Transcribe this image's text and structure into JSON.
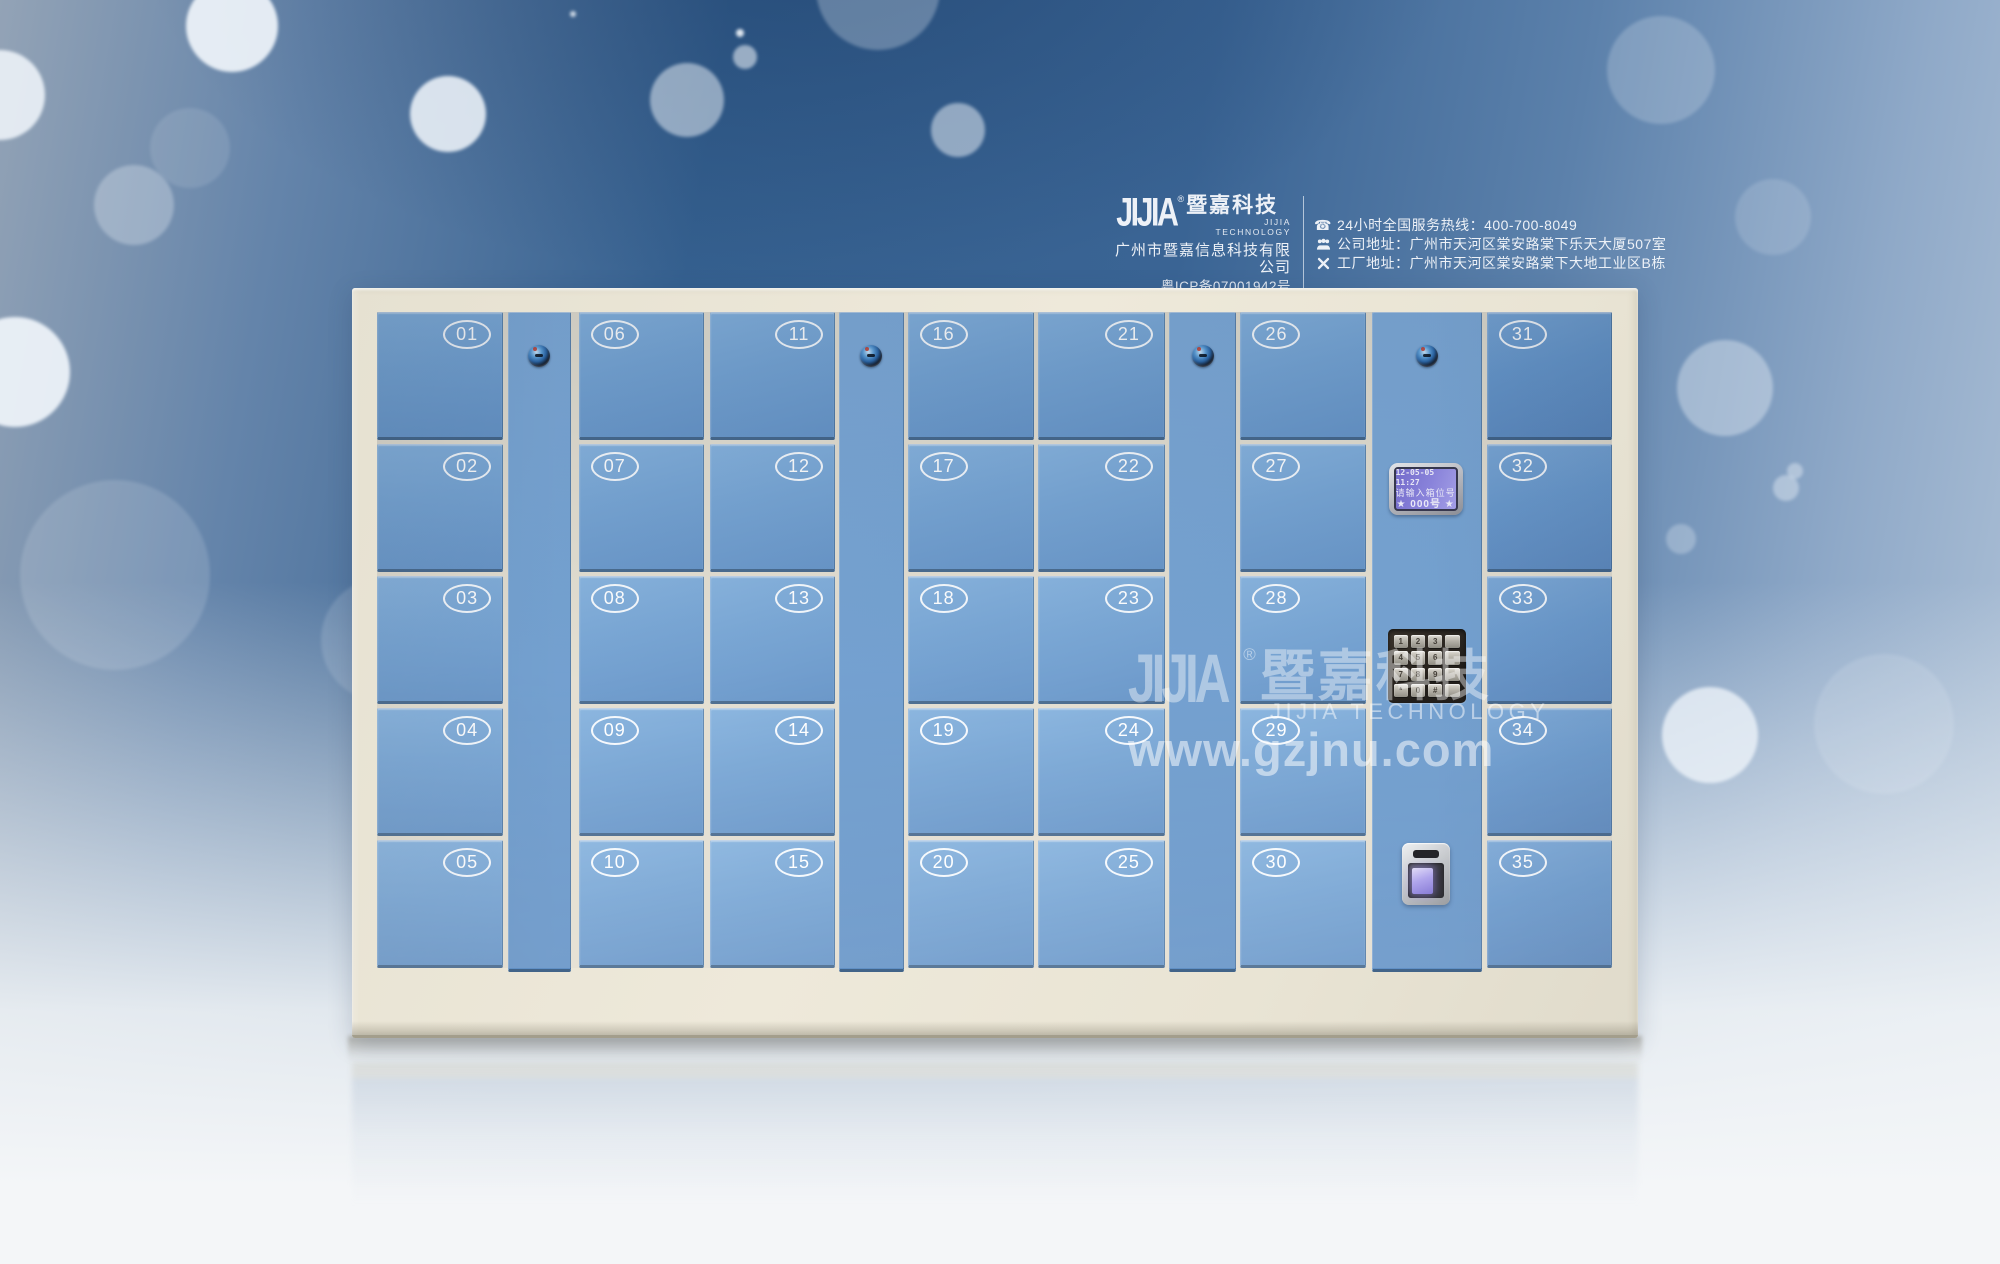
{
  "header": {
    "logo": {
      "jijia": "JIJIA",
      "reg": "®",
      "cn": "暨嘉科技",
      "en": "JIJIA TECHNOLOGY"
    },
    "company_name": "广州市暨嘉信息科技有限公司",
    "icp": "粤ICP备07001942号",
    "contact_lines": [
      {
        "icon": "phone-icon",
        "text": "24小时全国服务热线：400-700-8049"
      },
      {
        "icon": "people-icon",
        "text": "公司地址：广州市天河区棠安路棠下乐天大厦507室"
      },
      {
        "icon": "tools-icon",
        "text": "工厂地址：广州市天河区棠安路棠下大地工业区B栋"
      }
    ]
  },
  "watermark": {
    "jijia": "JIJIA",
    "reg": "®",
    "cn": "暨嘉科技",
    "en": "JIJIA TECHNOLOGY",
    "url": "www.gzjnu.com"
  },
  "locker": {
    "columns": [
      {
        "type": "doors",
        "numbers": [
          "01",
          "02",
          "03",
          "04",
          "05"
        ],
        "badge_side": "right"
      },
      {
        "type": "lock"
      },
      {
        "type": "doors",
        "numbers": [
          "06",
          "07",
          "08",
          "09",
          "10"
        ],
        "badge_side": "left"
      },
      {
        "type": "doors",
        "numbers": [
          "11",
          "12",
          "13",
          "14",
          "15"
        ],
        "badge_side": "right"
      },
      {
        "type": "lock"
      },
      {
        "type": "doors",
        "numbers": [
          "16",
          "17",
          "18",
          "19",
          "20"
        ],
        "badge_side": "left"
      },
      {
        "type": "doors",
        "numbers": [
          "21",
          "22",
          "23",
          "24",
          "25"
        ],
        "badge_side": "right"
      },
      {
        "type": "lock"
      },
      {
        "type": "doors",
        "numbers": [
          "26",
          "27",
          "28",
          "29",
          "30"
        ],
        "badge_side": "left"
      },
      {
        "type": "control"
      },
      {
        "type": "doors",
        "numbers": [
          "31",
          "32",
          "33",
          "34",
          "35"
        ],
        "badge_side": "left"
      }
    ],
    "control": {
      "lcd": {
        "line1": "12-05-05 11:27",
        "line2": "请输入箱位号",
        "line3": "★ 000号 ★"
      },
      "keypad_rows": [
        [
          "1",
          "2",
          "3",
          ""
        ],
        [
          "4",
          "5",
          "6",
          ""
        ],
        [
          "7",
          "8",
          "9",
          ""
        ],
        [
          "*",
          "0",
          "#",
          ""
        ]
      ]
    }
  },
  "colors": {
    "door_blue_light": "#84b1dd",
    "door_blue_dark": "#6392c6",
    "frame_cream": "#eae5d6",
    "bg_deep_blue": "#35608f",
    "lcd_purple": "#8d85e2",
    "fingerprint_glow": "#a79bea",
    "text_white": "#edf1f7"
  }
}
